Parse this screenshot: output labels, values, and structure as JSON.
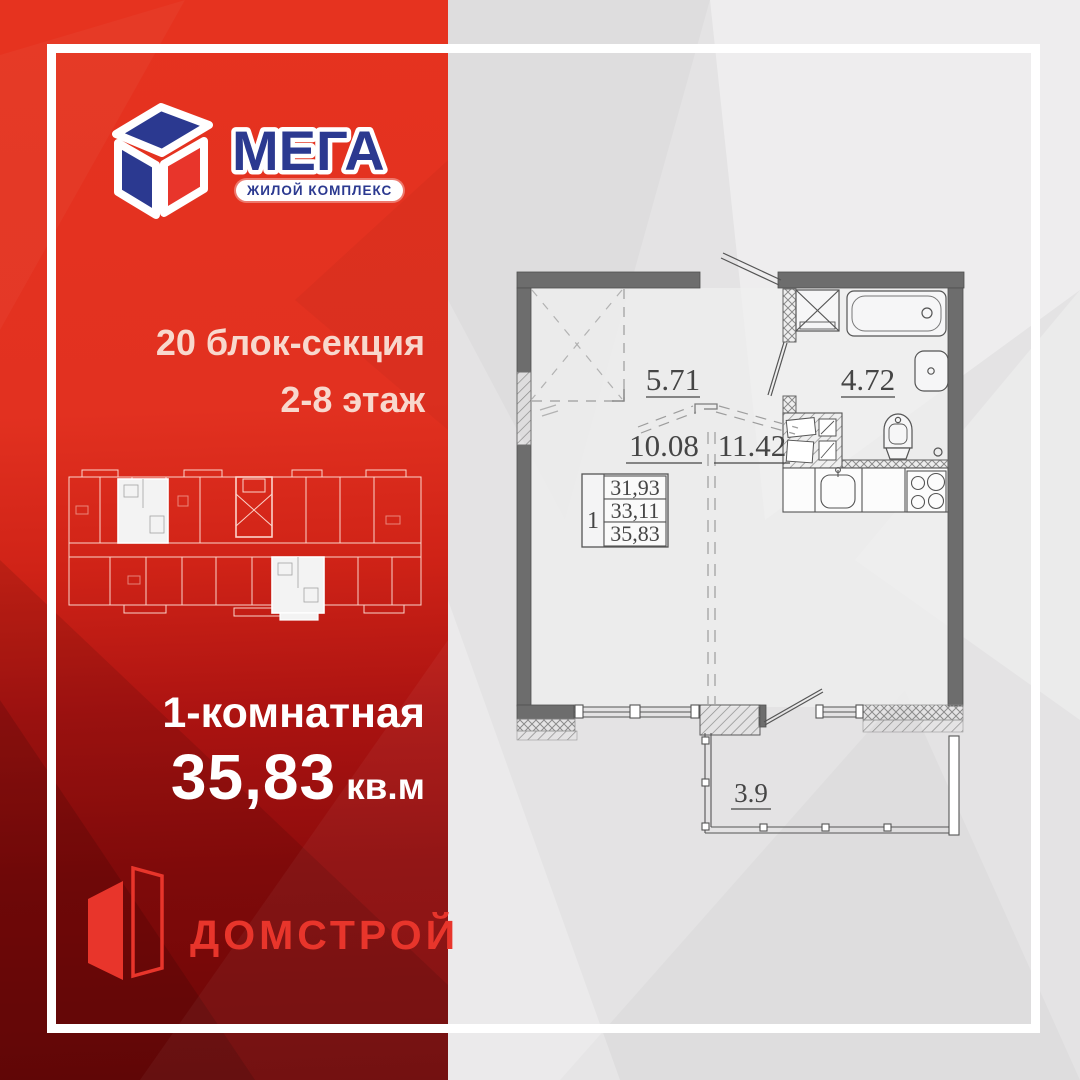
{
  "brand": {
    "name": "МЕГА",
    "tagline": "ЖИЛОЙ КОМПЛЕКС"
  },
  "left_panel": {
    "block_section": "20 блок-секция",
    "floors": "2-8 этаж",
    "apartment_type": "1-комнатная",
    "area_value": "35,83",
    "area_unit": "кв.м",
    "developer": "ДОМСТРОЙ"
  },
  "floor_plan": {
    "labels": {
      "wardrobe_zone": "5.71",
      "bathroom": "4.72",
      "living_zone": "10.08",
      "kitchen_zone": "11.42",
      "balcony": "3.9"
    },
    "area_table": {
      "unit_number": "1",
      "living_area": "31,93",
      "area_without_balcony": "33,11",
      "total_area": "35,83"
    }
  },
  "colors": {
    "brand_blue": "#2b3990",
    "brand_red": "#e8352b",
    "panel_red_top": "#e6331f",
    "panel_red_bottom": "#7a0808",
    "text_pink": "#f8d8cd",
    "plan_wall": "#6d6d6d",
    "bg_gray": "#e4e3e4"
  }
}
